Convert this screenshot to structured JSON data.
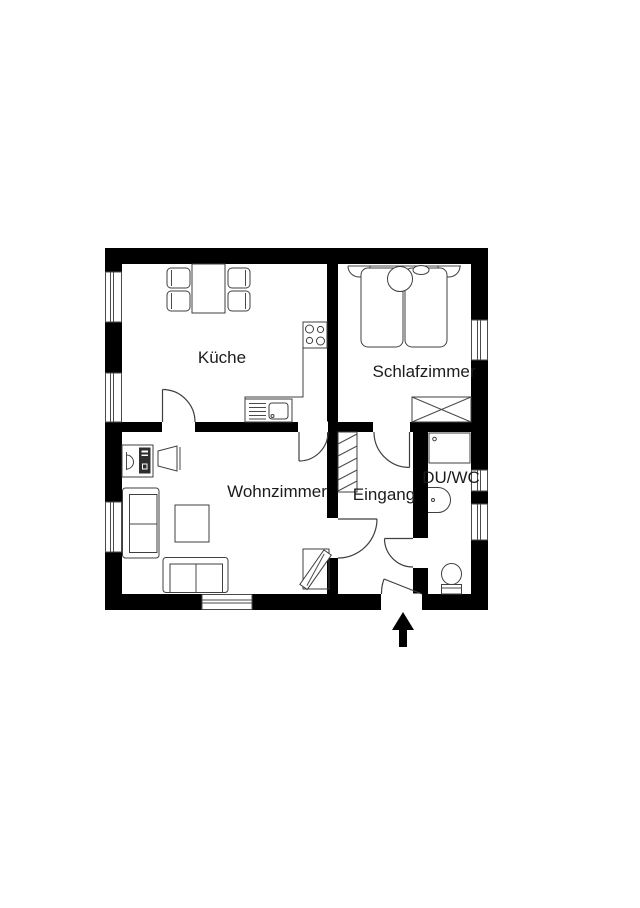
{
  "floorplan": {
    "colors": {
      "wall": "#000000",
      "furniture_line": "#3f3f3f",
      "background": "#ffffff",
      "text": "#1c1c1c"
    },
    "rooms": {
      "kitchen": {
        "label": "Küche"
      },
      "bedroom": {
        "label": "Schlafzimmer"
      },
      "living_room": {
        "label": "Wohnzimmer"
      },
      "entrance": {
        "label": "Eingang"
      },
      "bathroom": {
        "label": "DU/WC"
      }
    },
    "icons": {
      "kitchen": [
        "dining-table",
        "chair",
        "stove",
        "kitchen-counter",
        "sink"
      ],
      "bedroom": [
        "double-bed",
        "wardrobe"
      ],
      "living_room": [
        "desk",
        "computer",
        "desk-chair",
        "sofa",
        "coffee-table",
        "couch",
        "tv"
      ],
      "entrance": [
        "coat-rack",
        "entrance-arrow"
      ],
      "bathroom": [
        "shower",
        "washbasin",
        "toilet"
      ]
    }
  }
}
